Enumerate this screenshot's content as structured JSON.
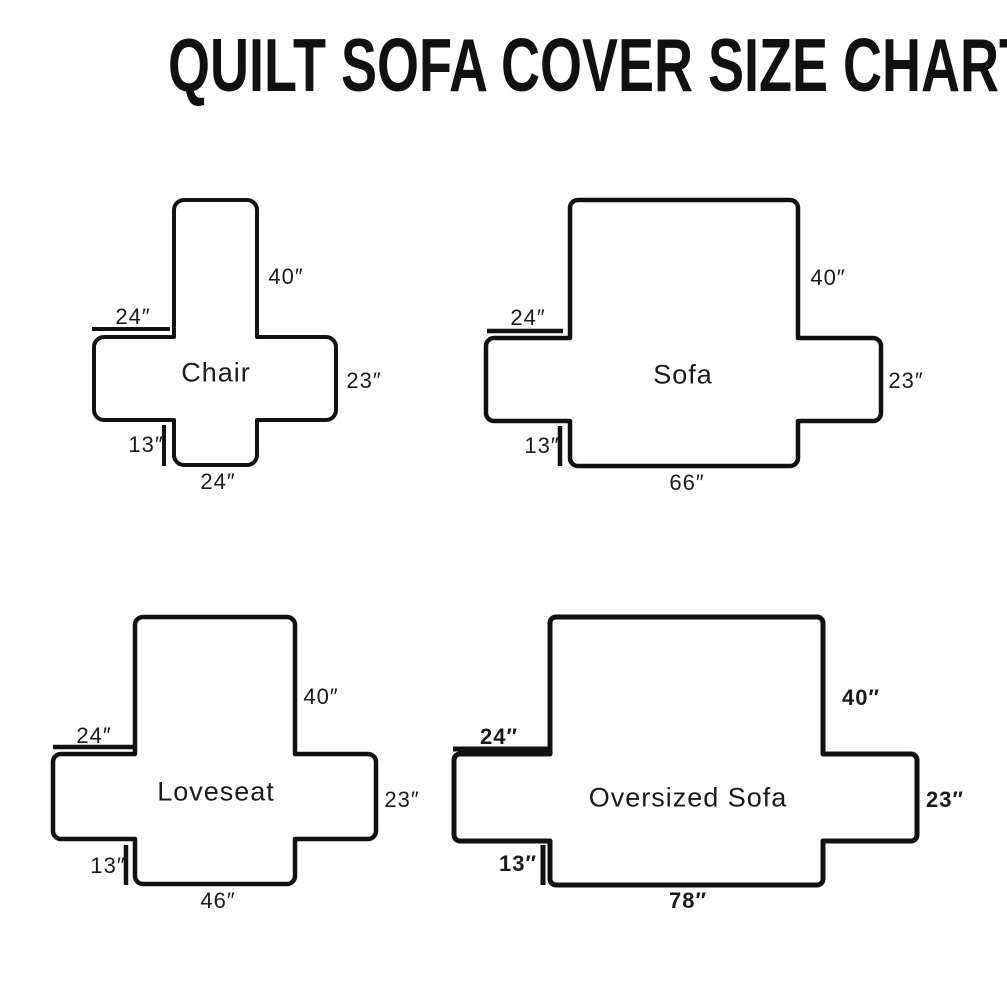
{
  "title": "QUILT SOFA COVER SIZE CHART",
  "colors": {
    "line": "#111111",
    "background": "#ffffff"
  },
  "diagrams": {
    "chair": {
      "name": "Chair",
      "back_height": "40″",
      "arm_top_width": "24″",
      "arm_side_height": "23″",
      "skirt_height": "13″",
      "base_width": "24″"
    },
    "sofa": {
      "name": "Sofa",
      "back_height": "40″",
      "arm_top_width": "24″",
      "arm_side_height": "23″",
      "skirt_height": "13″",
      "base_width": "66″"
    },
    "loveseat": {
      "name": "Loveseat",
      "back_height": "40″",
      "arm_top_width": "24″",
      "arm_side_height": "23″",
      "skirt_height": "13″",
      "base_width": "46″"
    },
    "oversized_sofa": {
      "name": "Oversized Sofa",
      "back_height": "40″",
      "arm_top_width": "24″",
      "arm_side_height": "23″",
      "skirt_height": "13″",
      "base_width": "78″"
    }
  }
}
